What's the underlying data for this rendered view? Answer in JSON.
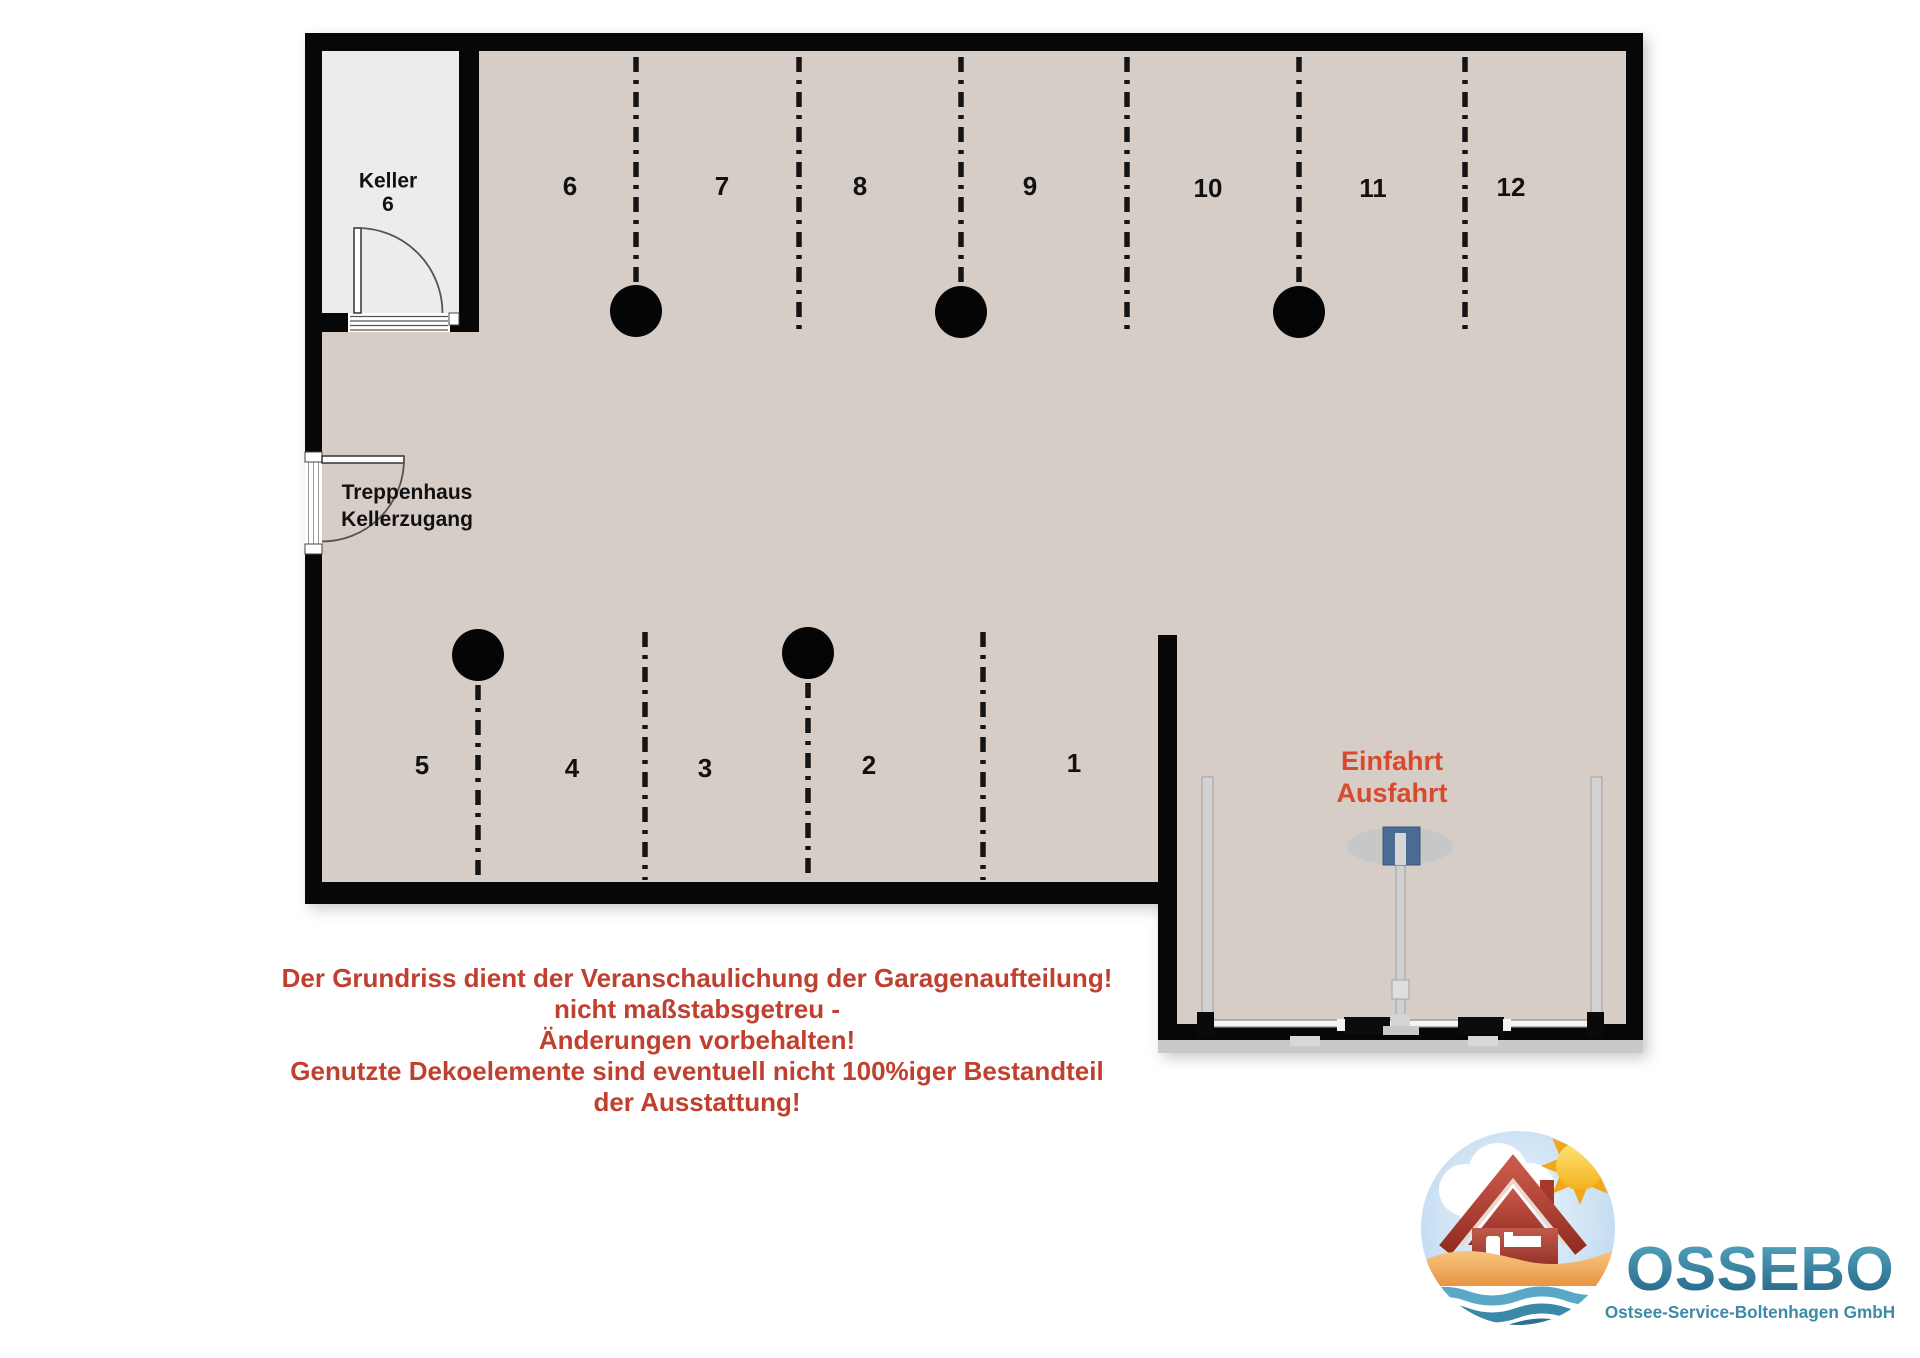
{
  "page": {
    "background": "#ffffff"
  },
  "plan": {
    "colors": {
      "floor": "#d7cdc7",
      "keller_floor": "#ececee",
      "wall": "#070707",
      "label": "#111111",
      "divider": "#151515",
      "entrance_red": "#d8492e",
      "gate_blue": "#4a6b94"
    },
    "rooms": {
      "keller": {
        "line1": "Keller",
        "line2": "6"
      },
      "stairwell": {
        "line1": "Treppenhaus",
        "line2": "Kellerzugang"
      }
    },
    "entrance": {
      "line1": "Einfahrt",
      "line2": "Ausfahrt"
    },
    "spaces_top": [
      "6",
      "7",
      "8",
      "9",
      "10",
      "11",
      "12"
    ],
    "spaces_bottom": [
      "5",
      "4",
      "3",
      "2",
      "1"
    ]
  },
  "disclaimer": {
    "color": "#c0402f",
    "lines": [
      "Der Grundriss dient der Veranschaulichung der Garagenaufteilung!",
      "nicht maßstabsgetreu -",
      "Änderungen vorbehalten!",
      "Genutzte Dekoelemente sind eventuell nicht 100%iger Bestandteil",
      "der Ausstattung!"
    ]
  },
  "logo": {
    "name": "OSSEBO",
    "subtitle": "Ostsee-Service-Boltenhagen GmbH",
    "colors": {
      "teal": "#3d8aa8",
      "sun": "#f2a71b",
      "house": "#a83527",
      "sand": "#eda14e",
      "water": "#2a7391",
      "sky": "#bdd9ef"
    }
  }
}
